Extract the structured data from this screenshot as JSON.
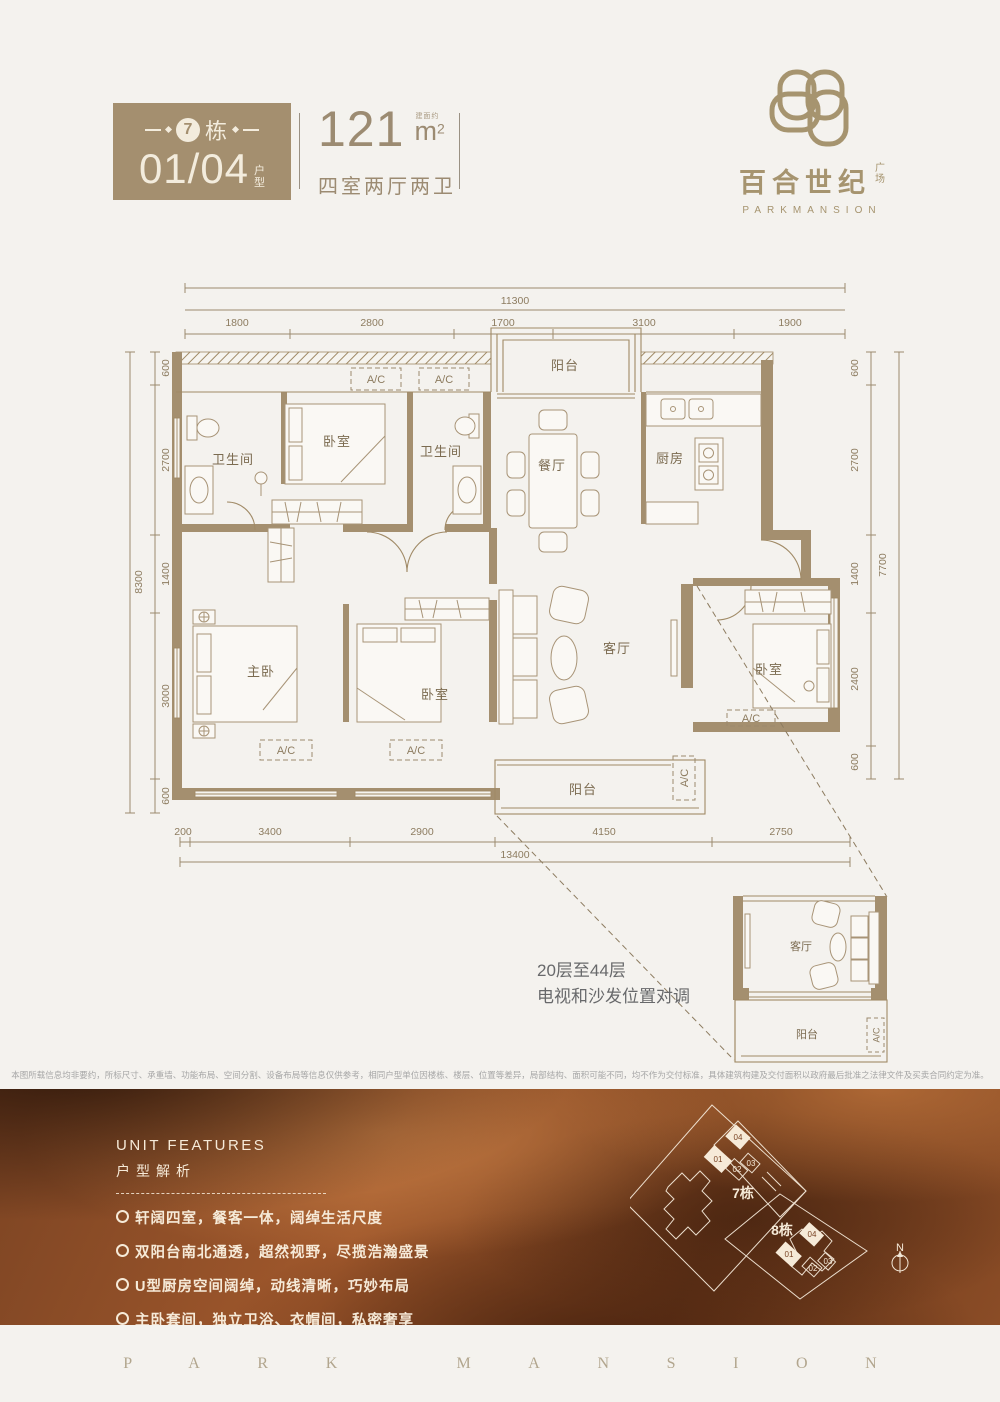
{
  "colors": {
    "brand_brown": "#a48f6f",
    "plan_line": "#a08a66",
    "cream": "#f3ecdd",
    "band_copper": "#8a4c26",
    "dim_text": "#8d7c60"
  },
  "header": {
    "building_num": "7",
    "building_suffix": "栋",
    "unit_code": "01/04",
    "unit_label": "户型",
    "area_value": "121",
    "area_prefix": "建面约",
    "area_unit": "m",
    "area_exp": "2",
    "layout": "四室两厅两卫"
  },
  "logo": {
    "cn": "百合世纪",
    "cn_suffix": "广场",
    "en": "PARKMANSION"
  },
  "plan": {
    "ac": "A/C",
    "dims_top": {
      "total": "11300",
      "segments": [
        "1800",
        "2800",
        "1700",
        "3100",
        "1900"
      ]
    },
    "dims_bottom": {
      "total": "13400",
      "segments": [
        "200",
        "3400",
        "2900",
        "4150",
        "2750"
      ]
    },
    "dims_left": {
      "total": "8300",
      "segments": [
        "600",
        "2700",
        "1400",
        "3000",
        "600"
      ]
    },
    "dims_right": {
      "total": "7700",
      "segments": [
        "600",
        "2700",
        "1400",
        "2400",
        "600"
      ]
    },
    "rooms": {
      "bath1": "卫生间",
      "bed_top": "卧室",
      "bath2": "卫生间",
      "balcony_top": "阳台",
      "dining": "餐厅",
      "kitchen": "厨房",
      "master": "主卧",
      "bed_mid": "卧室",
      "living": "客厅",
      "balcony_bottom": "阳台",
      "bed_right": "卧室"
    }
  },
  "inset": {
    "note1": "20层至44层",
    "note2": "电视和沙发位置对调",
    "living": "客厅",
    "balcony": "阳台",
    "ac": "A/C"
  },
  "disclaimer": "本图所载信息均非要约，所标尺寸、承重墙、功能布局、空间分割、设备布局等信息仅供参考，相同户型单位因楼栋、楼层、位置等差异，局部结构、面积可能不同，均不作为交付标准，具体建筑构建及交付面积以政府最后批准之法律文件及买卖合同约定为准。",
  "features": {
    "title_en": "UNIT FEATURES",
    "title_zh": "户型解析",
    "items": [
      "轩阔四室，餐客一体，阔绰生活尺度",
      "双阳台南北通透，超然视野，尽揽浩瀚盛景",
      "U型厨房空间阔绰，动线清晰，巧妙布局",
      "主卧套间，独立卫浴、衣帽间，私密奢享"
    ]
  },
  "siteplan": {
    "b7": "7栋",
    "b8": "8栋",
    "units": [
      "01",
      "02",
      "03",
      "04"
    ],
    "north": "N"
  },
  "footer": {
    "brand": "PARK MANSION"
  }
}
